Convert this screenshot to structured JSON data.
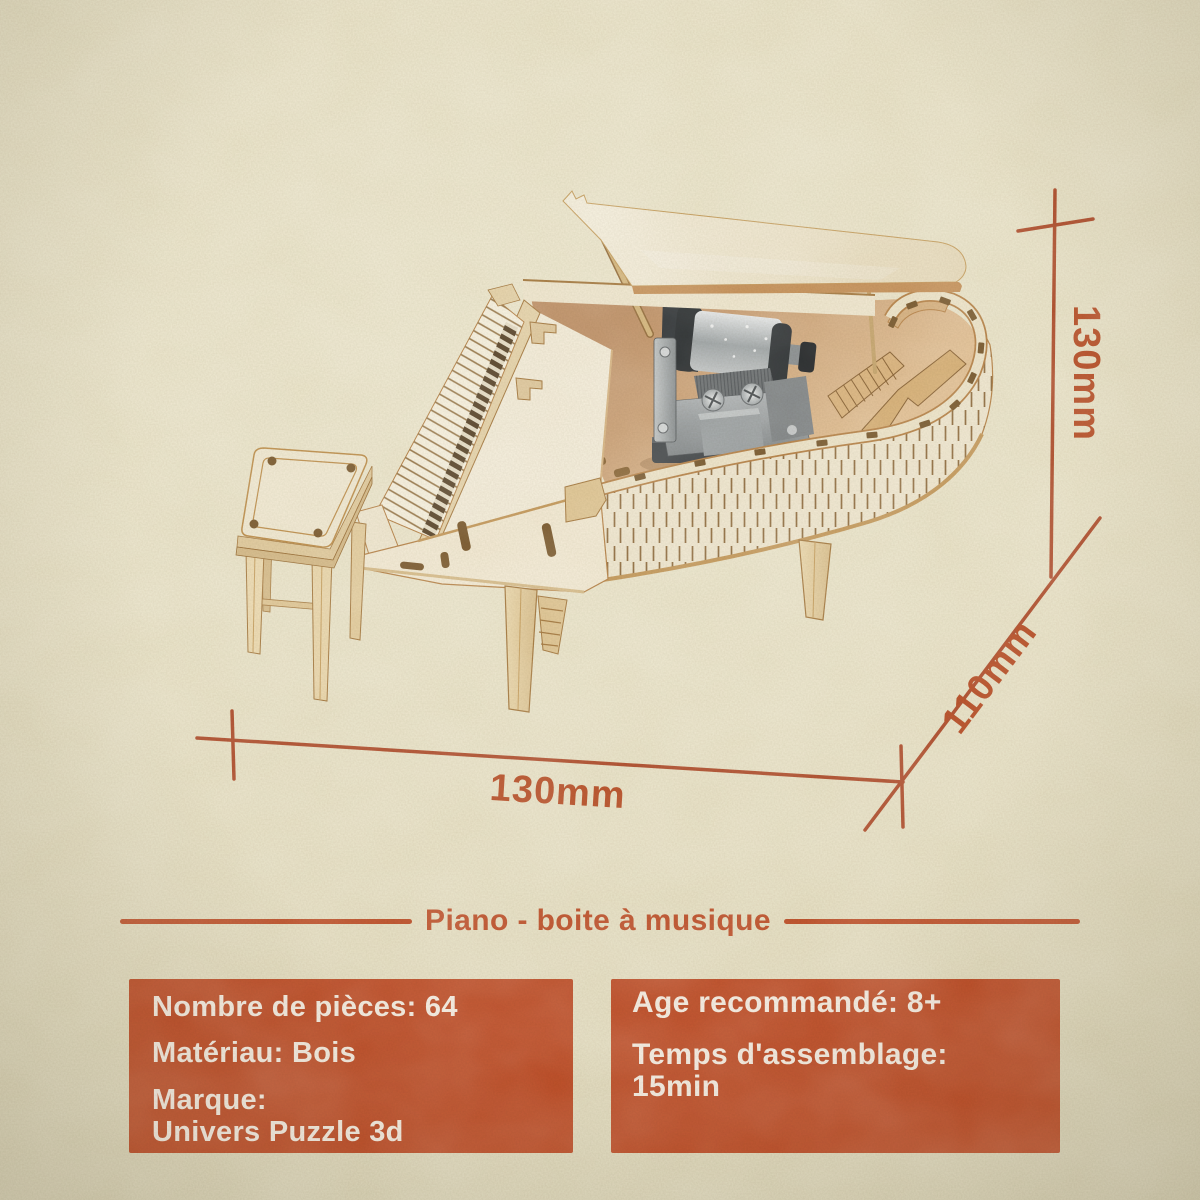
{
  "title": {
    "text": "Piano - boite à musique"
  },
  "dimensions": {
    "height": "130mm",
    "depth": "110mm",
    "width": "130mm"
  },
  "specs_left": {
    "pieces": "Nombre de pièces: 64",
    "material": "Matériau: Bois",
    "brand_label": "Marque:",
    "brand_value": "Univers Puzzle 3d"
  },
  "specs_right": {
    "age": "Age recommandé: 8+",
    "assembly_label": "Temps d'assemblage:",
    "assembly_value": "15min"
  },
  "colors": {
    "accent": "#C1532C",
    "dimension_line": "#B2502E",
    "dimension_text": "#BA5027",
    "box_background": "#C04E27",
    "box_text": "#F7EEE3",
    "paper": "#EAE3C7",
    "wood_face": "#F3EAD3",
    "wood_edge": "#B9854A",
    "metal": "#9EA3A5"
  },
  "illustration": {
    "subject": "wooden-3d-puzzle-grand-piano-music-box",
    "parts": [
      "piano-stool",
      "grand-piano-body",
      "piano-lid",
      "music-box-mechanism",
      "keyboard",
      "dimension-lines"
    ]
  }
}
